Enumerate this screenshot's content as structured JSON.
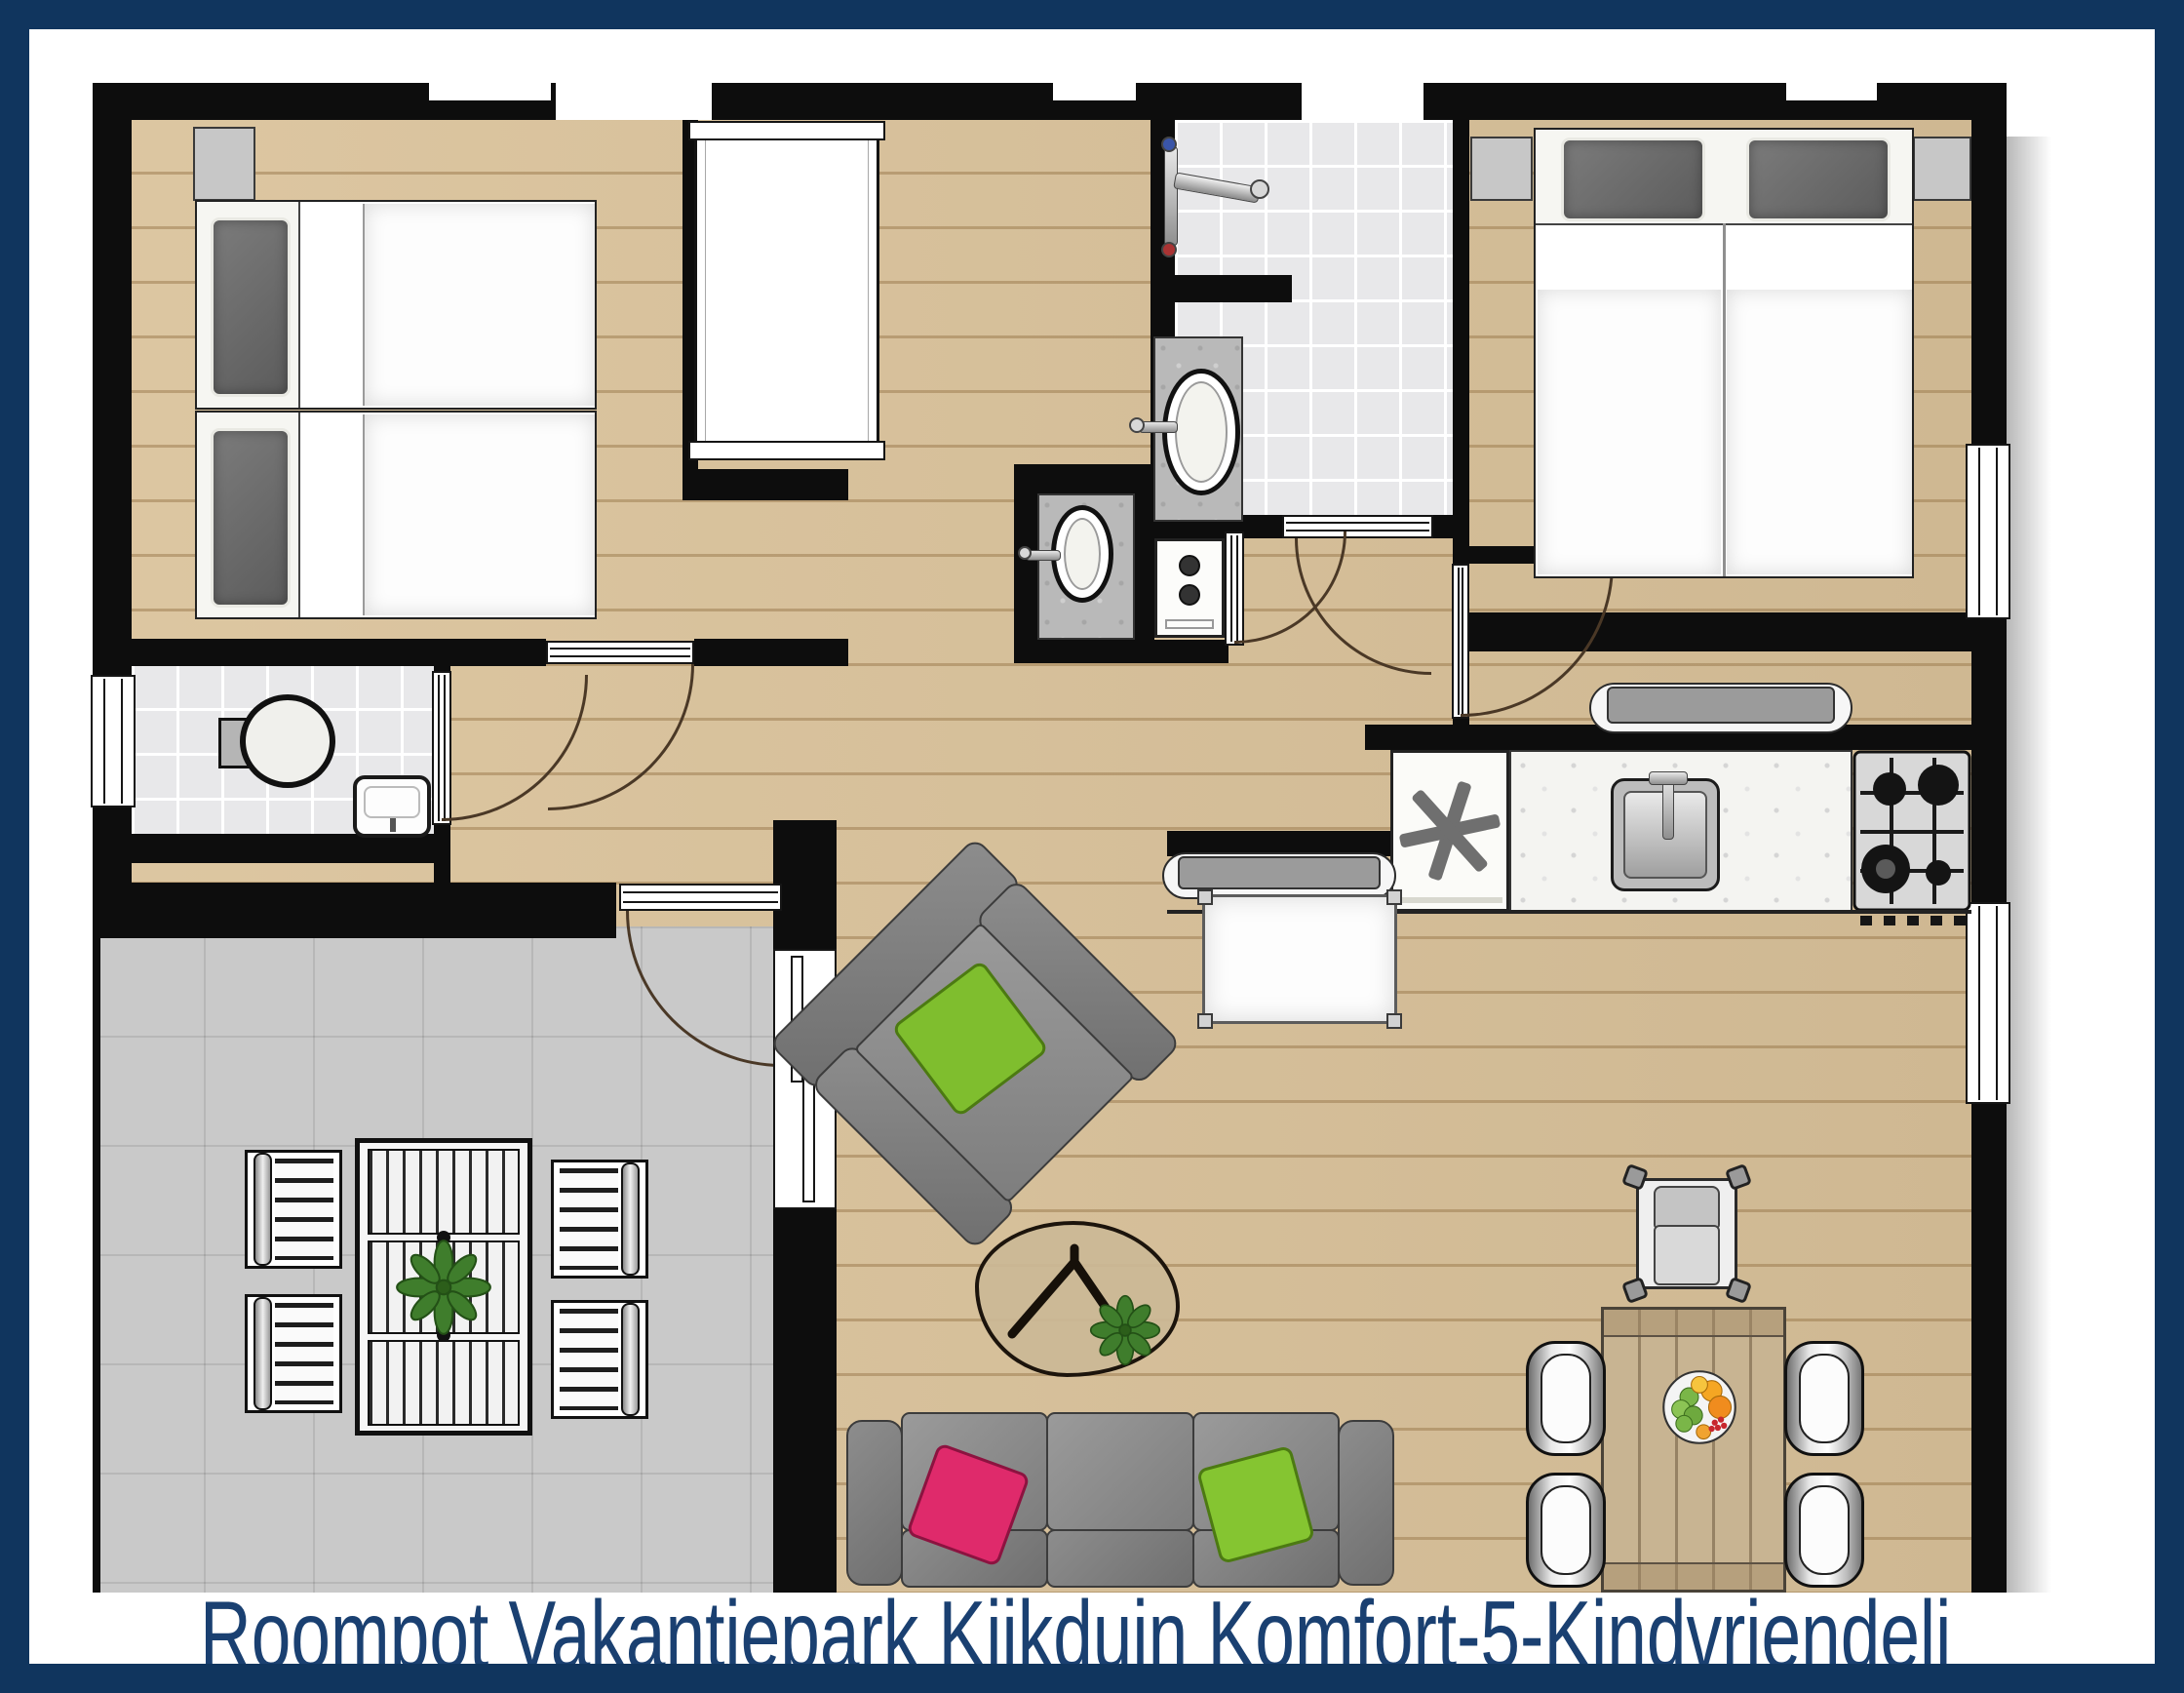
{
  "caption": "Roompot Vakantiepark Kijkduin Komfort-5-Kindvriendeli",
  "symbols": {
    "freezer": "✱",
    "sliding_door_arrow": "↓"
  },
  "colors": {
    "frame_navy": "#10355e",
    "caption_text": "#1a4071",
    "wall": "#0d0d0d",
    "wood_floor": "#dac29a",
    "terrace_tile": "#c9c9c9",
    "bath_tile": "#e8e8ea",
    "sofa_gray": "#8f8f8f",
    "accent_pink": "#df2a6b",
    "accent_green": "#84c72c",
    "plant_green": "#3f7d2c",
    "dining_wood": "#c8b492"
  },
  "rooms": [
    {
      "name": "bedroom-twin",
      "furniture": [
        "single bed",
        "single bed",
        "nightstand",
        "wardrobe"
      ]
    },
    {
      "name": "bedroom-double",
      "furniture": [
        "double bed",
        "nightstand",
        "nightstand"
      ]
    },
    {
      "name": "bathroom",
      "furniture": [
        "shower",
        "washbasin"
      ]
    },
    {
      "name": "toilet",
      "furniture": [
        "toilet",
        "hand basin"
      ]
    },
    {
      "name": "hallway",
      "furniture": [
        "washbasin",
        "boiler cabinet"
      ]
    },
    {
      "name": "kitchen",
      "furniture": [
        "freezer",
        "sink",
        "gas hob",
        "bench",
        "bench"
      ]
    },
    {
      "name": "living-room",
      "furniture": [
        "sofa",
        "armchair",
        "coffee table",
        "side table",
        "dining table",
        "dining chair x4",
        "high chair"
      ]
    },
    {
      "name": "terrace",
      "furniture": [
        "garden table",
        "garden chair x4",
        "plant"
      ]
    }
  ]
}
